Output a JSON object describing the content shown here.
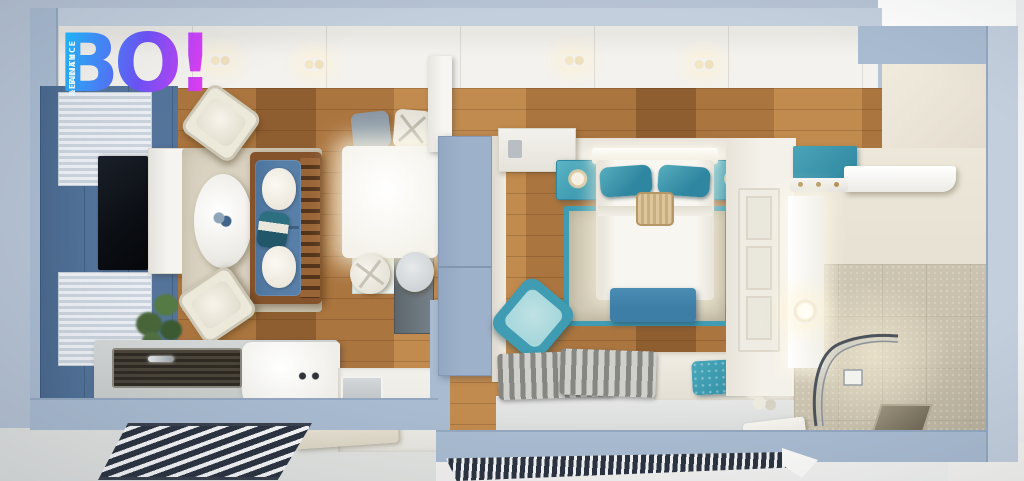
{
  "logo": {
    "title": "BO!",
    "tagline_line1": "REALITY",
    "tagline_line2": "& FINANCE"
  },
  "palette": {
    "bg": "#b6c3d4",
    "bgBottom": "#e1e3e0",
    "wallFace": "#a9bbd0",
    "wallLight": "#c3cfdd",
    "wallSide": "#93a8c0",
    "ceiling": "#f3f1ed",
    "wood": "#ab753f",
    "woodLight": "#c18a4e",
    "woodDark": "#8f5e30",
    "accentWall": "#54749b",
    "rugLiving": "#d9d2c1",
    "sofaBlue": "#587fa7",
    "sofaWood": "#84532c",
    "pillowTeal": "#2b6f80",
    "cream": "#ece8da",
    "chairGray": "#9aa7b3",
    "cabinet": "#9db1ca",
    "teal": "#3f9cb2",
    "tealDeep": "#2f86a0",
    "benchBlue": "#3c7ea6",
    "cushionMint": "#a9d8dc",
    "rugBed": "#cfc8b4",
    "bathCream": "#e7e1d3",
    "bathTile": "#c9c1ad",
    "radiator": "#2c3340",
    "radiatorLight": "#f5f6f7",
    "logoStart": "#1fb4f5",
    "logoMid": "#6a52f2",
    "logoEnd": "#e13bf0"
  }
}
